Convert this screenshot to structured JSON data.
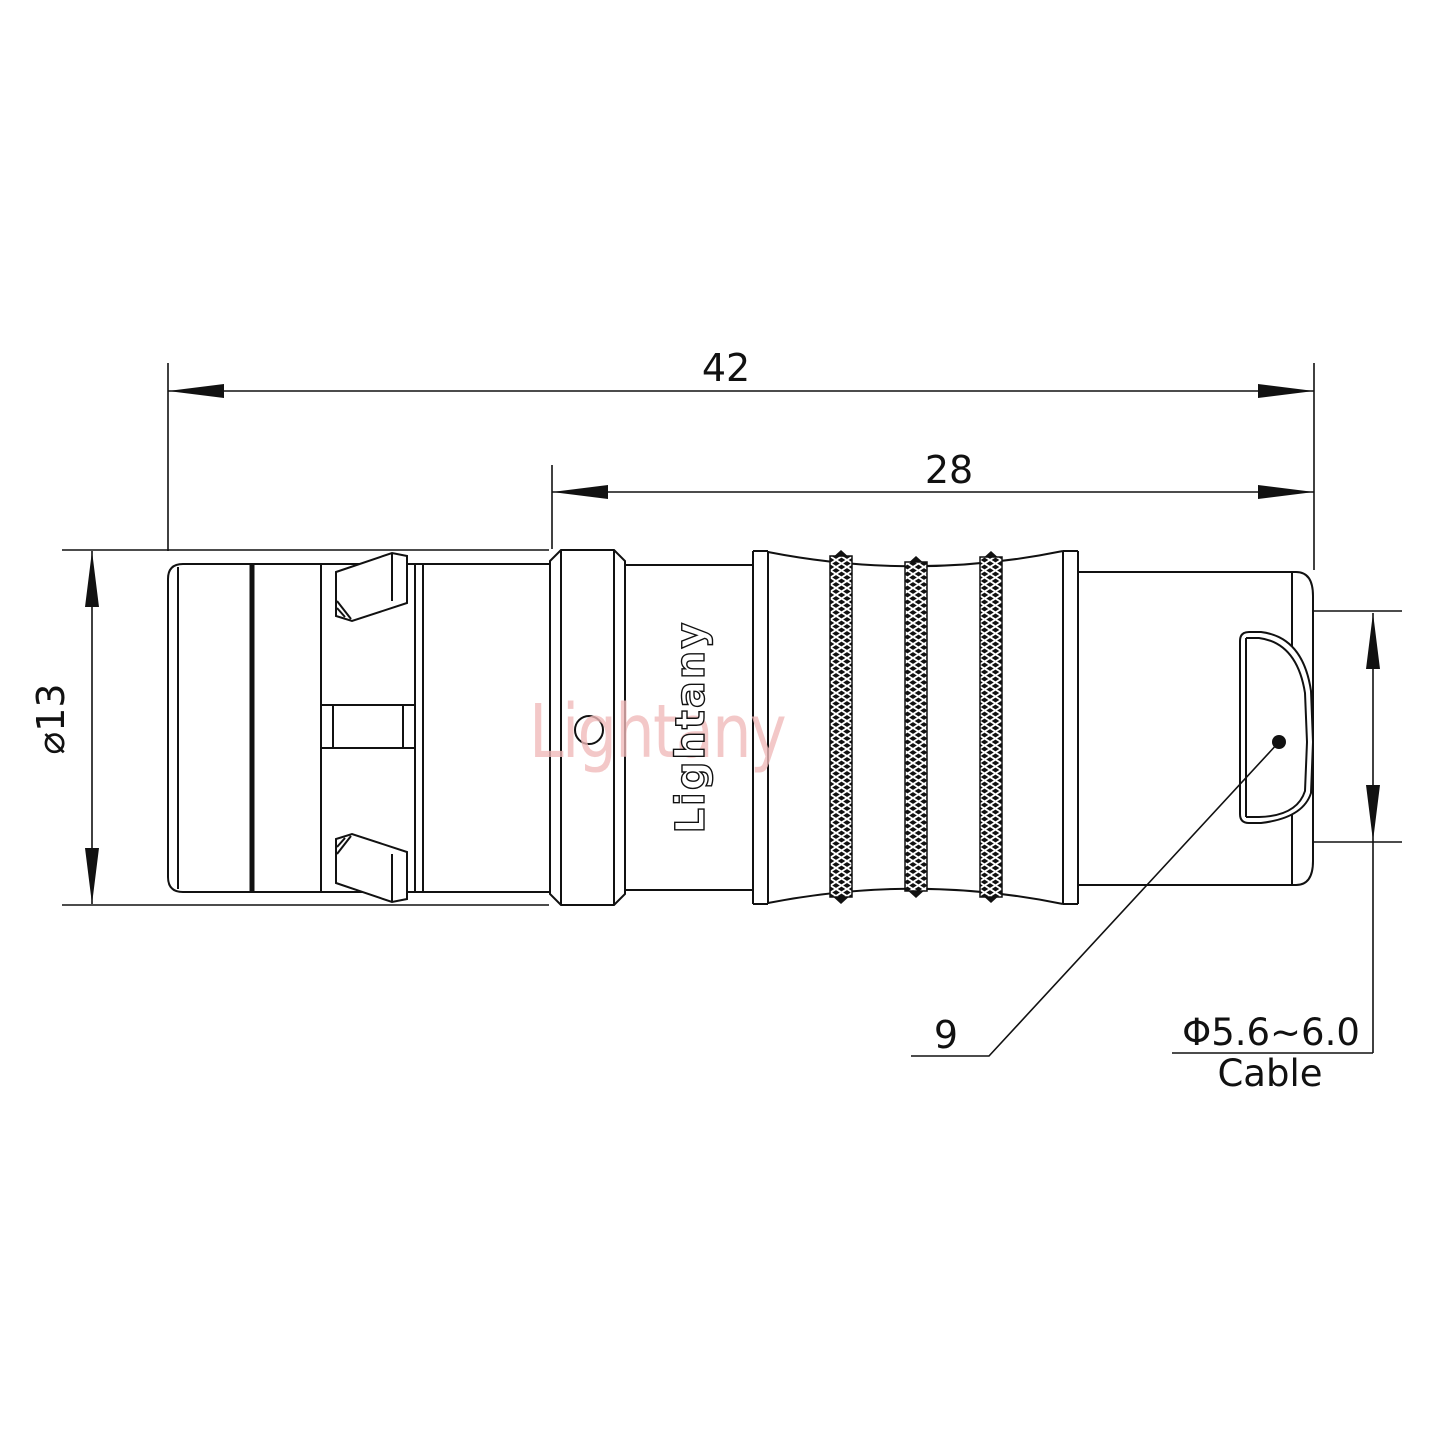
{
  "drawing": {
    "type": "connector-technical-drawing",
    "dimensions": {
      "overall_length": "42",
      "grip_length": "28",
      "body_diameter": "⌀13",
      "ref_number": "9",
      "cable_diameter": "Φ5.6~6.0",
      "cable_label": "Cable"
    },
    "branding": {
      "watermark": "Lightany",
      "engraving": "Lightany"
    },
    "colors": {
      "line": "#111111",
      "watermark_pink": "#f0b9b9",
      "background": "#ffffff"
    }
  }
}
